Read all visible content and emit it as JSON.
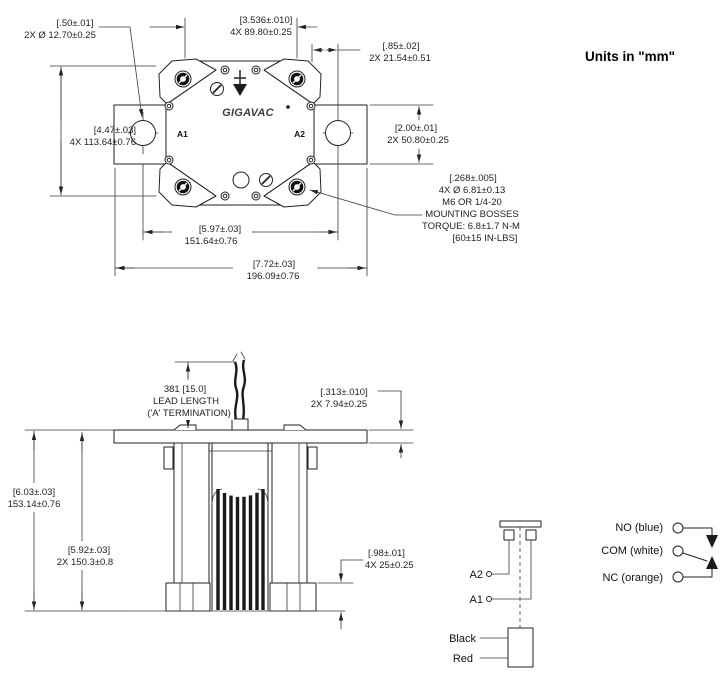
{
  "units_note": "Units in \"mm\"",
  "top_view": {
    "logo": "GIGAVAC",
    "a1": "A1",
    "a2": "A2",
    "dim_hole": {
      "l1": "[.50±.01]",
      "l2": "2X Ø 12.70±0.25"
    },
    "dim_screws": {
      "l1": "[3.536±.010]",
      "l2": "4X 89.80±0.25"
    },
    "dim_offset": {
      "l1": "[.85±.02]",
      "l2": "2X 21.54±0.51"
    },
    "dim_bar": {
      "l1": "[2.00±.01]",
      "l2": "2X 50.80±0.25"
    },
    "dim_height": {
      "l1": "[4.47±.03]",
      "l2": "4X 113.64±0.76"
    },
    "dim_holespan": {
      "l1": "[5.97±.03]",
      "l2": "151.64±0.76"
    },
    "dim_overall": {
      "l1": "[7.72±.03]",
      "l2": "196.09±0.76"
    },
    "note_bosses": [
      "[.268±.005]",
      "4X Ø 6.81±0.13",
      "M6 OR 1/4-20",
      "MOUNTING BOSSES",
      "TORQUE: 6.8±1.7 N-M",
      "[60±15 IN-LBS]"
    ]
  },
  "side_view": {
    "note_lead": [
      "381 [15.0]",
      "LEAD LENGTH",
      "('A' TERMINATION)"
    ],
    "dim_flange": {
      "l1": "[.313±.010]",
      "l2": "2X 7.94±0.25"
    },
    "dim_overall": {
      "l1": "[6.03±.03]",
      "l2": "153.14±0.76"
    },
    "dim_body": {
      "l1": "[5.92±.03]",
      "l2": "2X 150.3±0.8"
    },
    "dim_boss": {
      "l1": "[.98±.01]",
      "l2": "4X 25±0.25"
    }
  },
  "schematic": {
    "a2": "A2",
    "a1": "A1",
    "black": "Black",
    "red": "Red",
    "no": "NO (blue)",
    "com": "COM (white)",
    "nc": "NC (orange)"
  }
}
